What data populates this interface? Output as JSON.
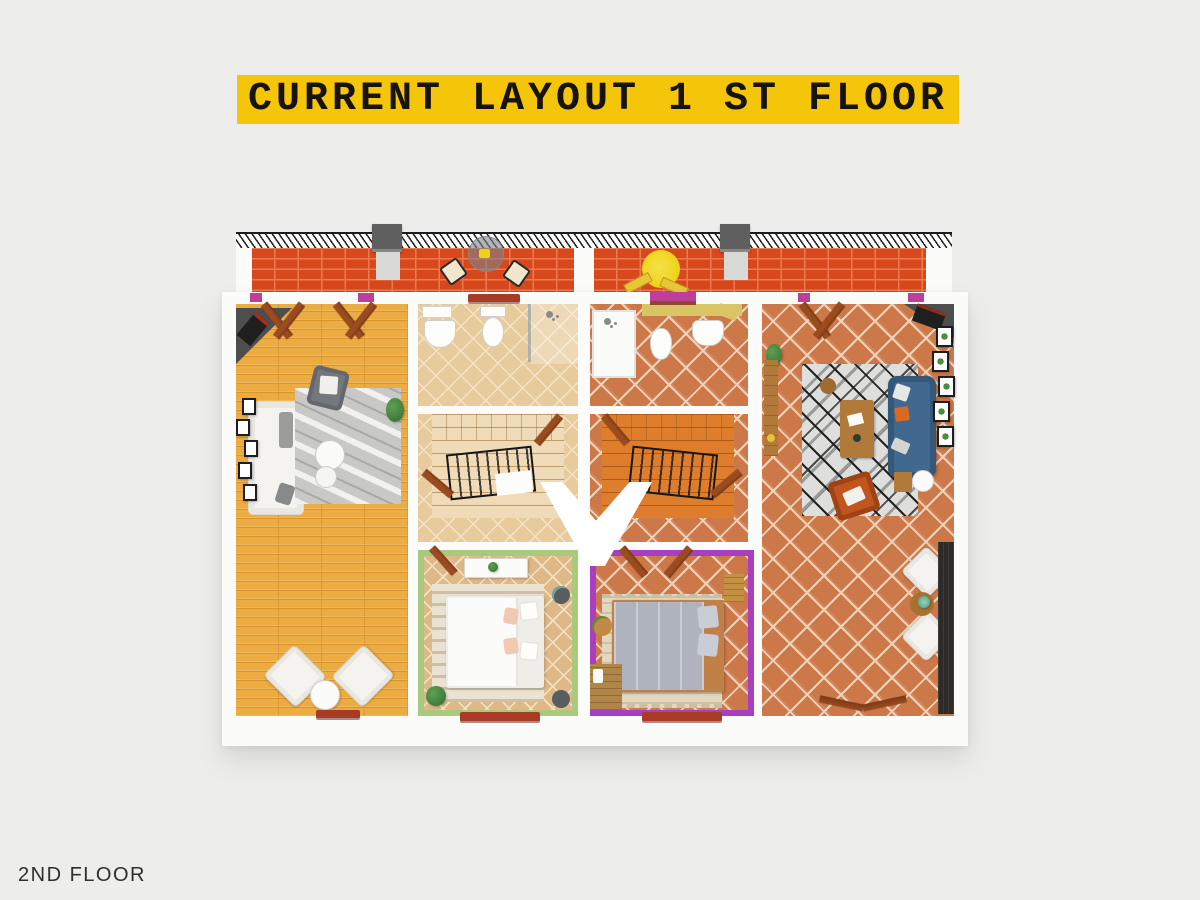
{
  "banner": {
    "text": "CURRENT LAYOUT 1 ST FLOOR"
  },
  "footer": {
    "label": "2ND FLOOR"
  },
  "floorplan": {
    "type": "3d-top-down-floor-plan",
    "view": "first floor of a duplex, two mirrored units",
    "terrace": {
      "position": "top",
      "floor": "red-brick",
      "features": [
        "metal-railing",
        "chimney-left",
        "chimney-right",
        "bistro-table",
        "two-chairs",
        "yellow-umbrella",
        "sun-loungers",
        "magenta-planter"
      ]
    },
    "units": [
      {
        "name": "left-unit",
        "rooms": [
          {
            "name": "living-room",
            "floor": "golden-wood-planks",
            "furniture": [
              "corner-stove",
              "white-sofa",
              "marble-gray-rug",
              "gray-armchair",
              "two-round-coffee-tables",
              "wall-picture-frames",
              "plant",
              "two-white-armchairs",
              "round-side-table"
            ]
          },
          {
            "name": "bathroom",
            "floor": "tan-diagonal-tile",
            "furniture": [
              "sink",
              "toilet",
              "shower",
              "glass-divider"
            ]
          },
          {
            "name": "stair-hall",
            "floor": "tan-diagonal-tile",
            "furniture": [
              "winding-staircase-cream",
              "black-railing"
            ]
          },
          {
            "name": "bedroom",
            "walls": "green",
            "floor": "tan-diagonal-tile",
            "furniture": [
              "white-dresser",
              "white-double-bed",
              "patterned-rug",
              "two-round-nightstands",
              "plant"
            ]
          }
        ]
      },
      {
        "name": "right-unit",
        "rooms": [
          {
            "name": "bathroom",
            "floor": "terracotta-tile",
            "furniture": [
              "walk-in-shower",
              "bidet",
              "sink",
              "yellow-counter"
            ]
          },
          {
            "name": "stair-hall",
            "floor": "terracotta-tile",
            "furniture": [
              "winding-staircase-orange",
              "black-railing"
            ]
          },
          {
            "name": "bedroom",
            "walls": "purple",
            "floor": "terracotta-tile",
            "furniture": [
              "gray-double-bed",
              "fringed-rug",
              "wooden-bench",
              "round-side-table",
              "wooden-chest"
            ]
          },
          {
            "name": "living-room",
            "floor": "terracotta-tile",
            "furniture": [
              "corner-stove",
              "blue-sofa",
              "geometric-bw-rug",
              "wooden-coffee-table",
              "orange-armchair",
              "round-stool",
              "wooden-console",
              "botanical-picture-frames",
              "two-white-armchairs",
              "round-wood-table",
              "dark-deck-strip"
            ]
          }
        ]
      }
    ]
  },
  "colors": {
    "page_bg": "#EDEEEB",
    "banner_bg": "#F4C508",
    "banner_text": "#17130E",
    "footer_text": "#2E2E2E",
    "wall": "#FBFBFA",
    "brick": "#D7481D",
    "brick_joint": "#EA7B50",
    "railing_hatch": "#202020",
    "chimney": "#5F5F5F",
    "wood_floor": "#ECAC41",
    "wood_line": "#D89430",
    "tan_tile": "#E7CB9D",
    "tan_grout": "#F5E4C4",
    "bedroom_tan": "#DFB888",
    "terracotta": "#CD7848",
    "terracotta_grout": "#EFD3B9",
    "stair_left": "#F0DBB8",
    "stair_left_line": "#C09B66",
    "stair_right": "#DE7D2C",
    "stair_right_line": "#AE5B1A",
    "green_wall": "#A9CA7D",
    "purple_wall": "#A83FC0",
    "blue_sofa": "#41688E",
    "orange_chair": "#C0561D",
    "rug_marble": "#C8C8C6",
    "rug_geo": "#DEDEDC",
    "rug_stripe": "#EAE3D1",
    "rug_fringe": "#E2D8C0",
    "bed_gray": "#AEB3BD",
    "wood_furn": "#B27A3A",
    "door_wood": "#9A4B20",
    "sill_red": "#A93A26",
    "stove_dark": "#1F1F1F",
    "hearth_gray": "#4E4E4E",
    "deck_dark": "#2D2B27",
    "umbrella_yellow": "#EFD214",
    "planter_magenta": "#BE3E9A",
    "counter_yellow": "#D9C566",
    "plant_green": "#3F7C3B",
    "white_furn": "#F4F3F0"
  }
}
